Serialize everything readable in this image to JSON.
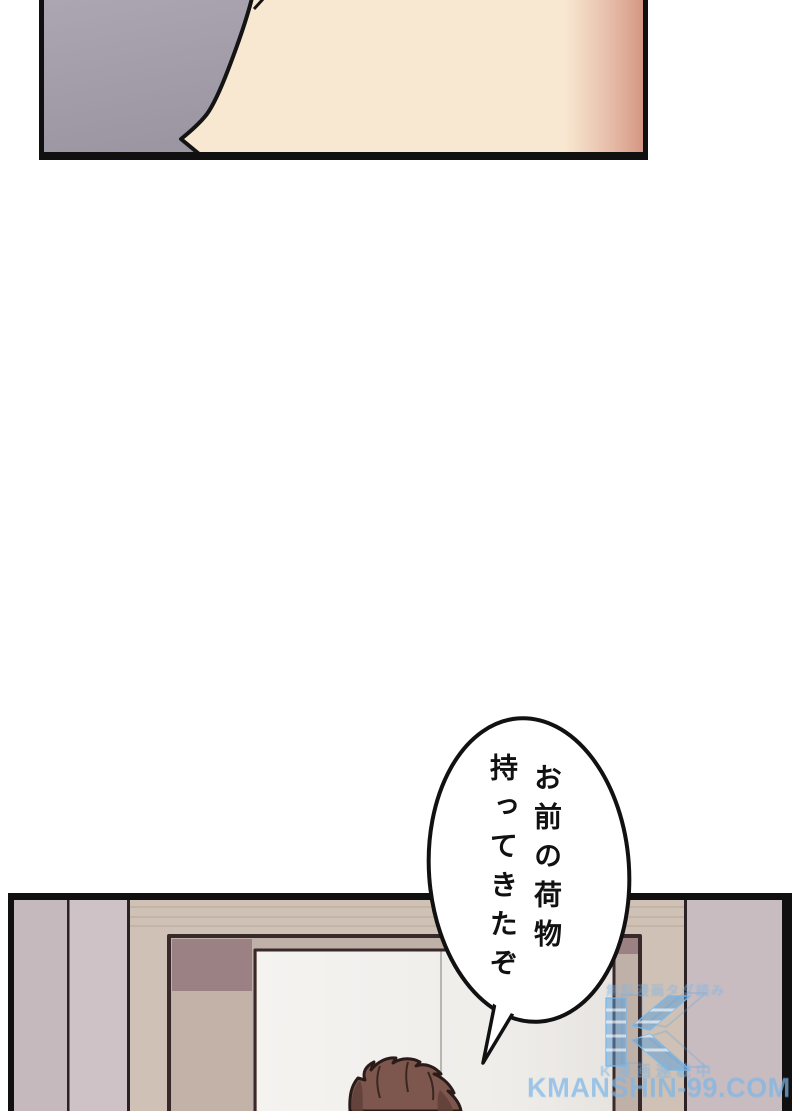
{
  "page": {
    "type": "manga-page",
    "background": "#ffffff"
  },
  "panels": {
    "top_panel": {
      "left_shade_color": "#a49eab",
      "skin_color": "#f9e8d1",
      "skin_edge_color": "#d89d8b",
      "border_color": "#101010"
    },
    "bottom_panel": {
      "wall_color": "#c8bcc0",
      "wood_color": "#cfc1b5",
      "door_frame_dark": "#9b8183",
      "door_frame_light": "#c3b2a7",
      "opening_color": "#f4f2ef",
      "hair_color": "#7d574e",
      "border_color": "#101010"
    }
  },
  "speech_bubble": {
    "lines": [
      "お前の荷物",
      "持ってきたぞ"
    ]
  },
  "watermark": {
    "site": "KMANSHIN-99.COM",
    "tagline_top": "無料漫画タダ読み",
    "tagline_bottom": "K漫画連載中",
    "logo_letter": "K",
    "color": "#7cb6e6"
  }
}
